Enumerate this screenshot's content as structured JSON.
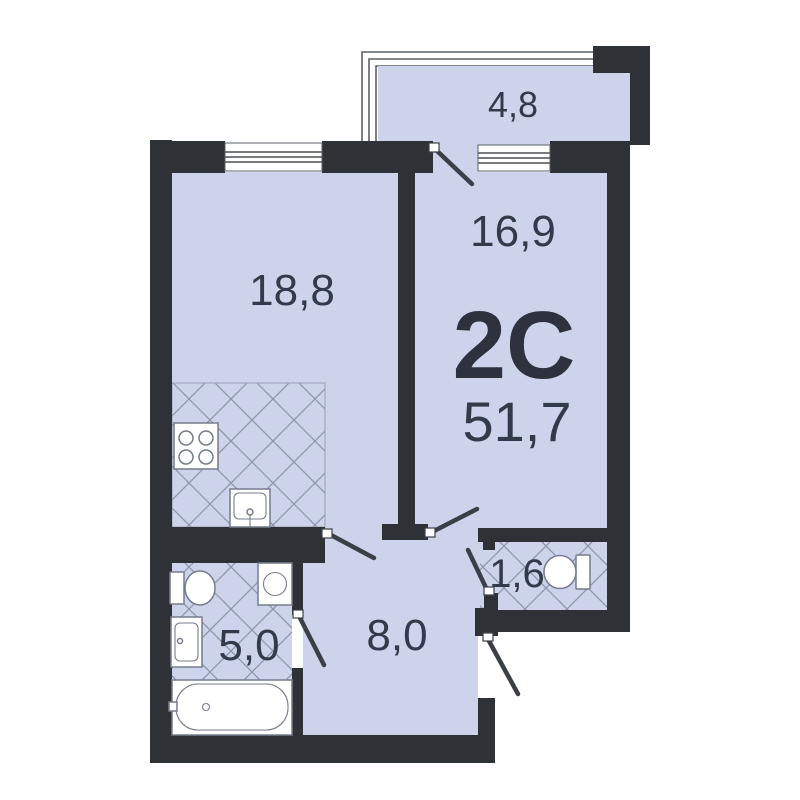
{
  "apartment": {
    "type_label": "2С",
    "total_area": "51,7",
    "rooms": {
      "balcony": {
        "label": "4,8"
      },
      "living": {
        "label": "18,8"
      },
      "bedroom": {
        "label": "16,9"
      },
      "bathroom": {
        "label": "5,0"
      },
      "hallway": {
        "label": "8,0"
      },
      "wc": {
        "label": "1,6"
      }
    }
  },
  "colors": {
    "wall": "#2e3236",
    "floor": "#ccd3ea",
    "hatch_line": "#8b93a6",
    "door": "#3b4046",
    "fixture_outline": "#757c8d",
    "label_text": "#333b4a",
    "type_text": "#2d323e",
    "background": "#ffffff"
  }
}
